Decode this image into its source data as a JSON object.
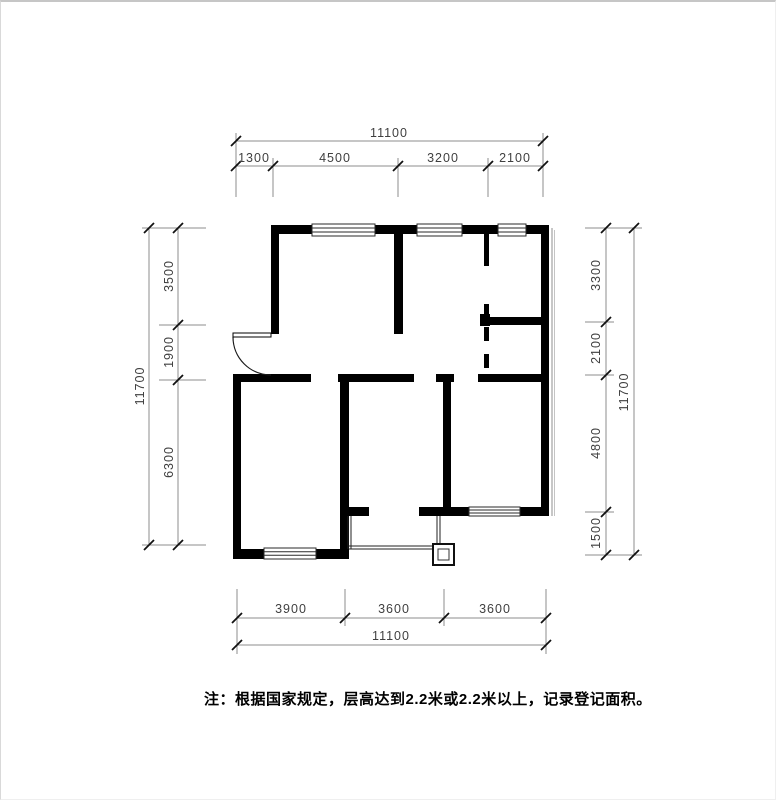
{
  "dims": {
    "top": {
      "total": "11100",
      "segments": [
        "1300",
        "4500",
        "3200",
        "2100"
      ]
    },
    "bottom": {
      "total": "11100",
      "segments": [
        "3900",
        "3600",
        "3600"
      ]
    },
    "left": {
      "total": "11700",
      "segments": [
        "3500",
        "1900",
        "6300"
      ]
    },
    "right": {
      "total": "11700",
      "segments": [
        "3300",
        "2100",
        "4800",
        "1500"
      ]
    }
  },
  "note": "注：根据国家规定，层高达到2.2米或2.2米以上，记录登记面积。",
  "colors": {
    "wall": "#000000",
    "dim_line": "#8c8c8c",
    "dim_text": "#3f3f3f",
    "tick": "#111111",
    "page_bg": "#ffffff",
    "page_border": "#c6c6c6"
  }
}
